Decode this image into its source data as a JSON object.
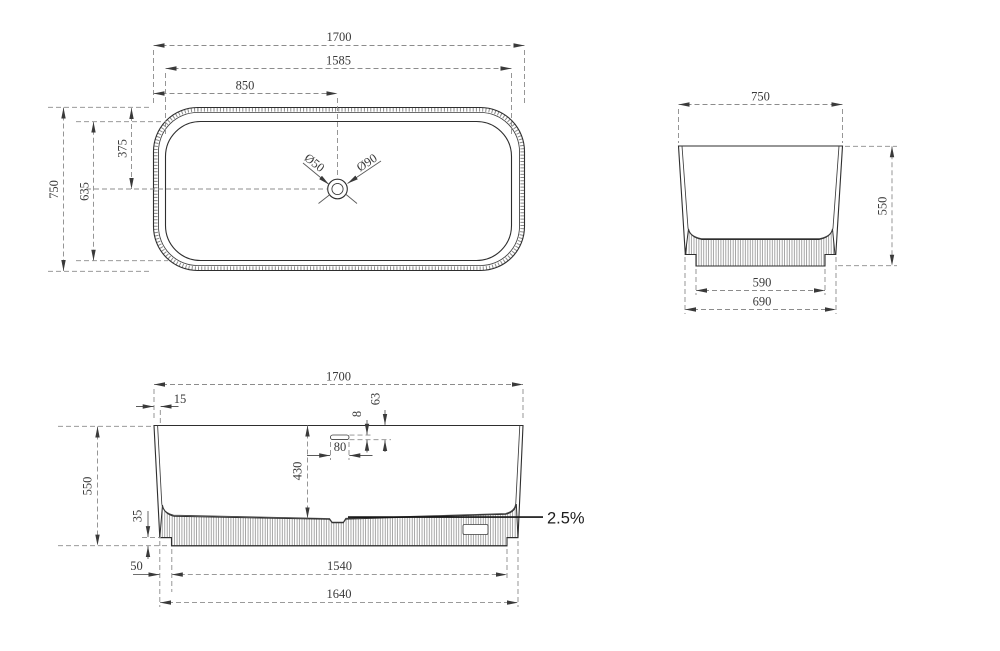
{
  "drawing": {
    "description": "CAD technical drawing of freestanding fluted bathtub, three orthographic views",
    "background": "#ffffff",
    "line_color": "#2e2e2e",
    "dim_line_color": "#8c8c8c",
    "text_color": "#3a3a3a",
    "views": {
      "plan": {
        "dims": {
          "overall_length": "1700",
          "inner_length": "1585",
          "drain_from_left": "850",
          "drain_from_top": "375",
          "inner_width": "635",
          "overall_width": "750"
        },
        "drain": {
          "inner_diameter": "Ø50",
          "outer_diameter": "Ø90"
        }
      },
      "end": {
        "dims": {
          "overall_width": "750",
          "overall_height": "550",
          "base_width": "590",
          "bottom_width": "690"
        }
      },
      "side": {
        "dims": {
          "overall_length": "1700",
          "rim_thickness": "15",
          "overflow_from_top": "63",
          "overflow_slot_height": "8",
          "overflow_slot_width": "80",
          "inner_depth": "430",
          "overall_height": "550",
          "base_height": "35",
          "base_inset": "50",
          "base_length": "1540",
          "bottom_length": "1640"
        },
        "slope_label": "2.5%"
      }
    }
  }
}
